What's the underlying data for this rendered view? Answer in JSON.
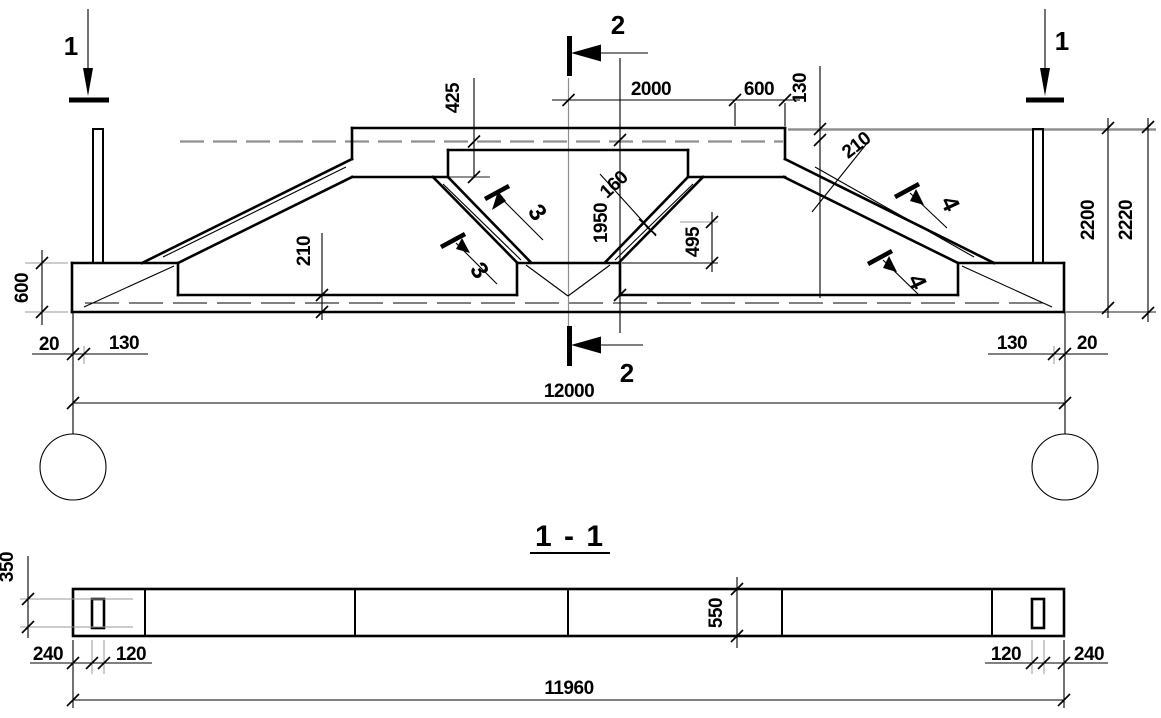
{
  "drawing": {
    "kind": "engineering-truss-drawing",
    "background": "#ffffff",
    "line_color": "#000000",
    "aux_line_color": "#8f8f8f"
  },
  "elevation": {
    "markers": {
      "cut1_left": "1",
      "cut1_right": "1",
      "cut2_top": "2",
      "cut2_bottom": "2",
      "cut3_upper": "3",
      "cut3_lower": "3",
      "cut4_upper": "4",
      "cut4_lower": "4"
    },
    "dims": {
      "top_center": "2000",
      "top_right": "600",
      "edge_130": "130",
      "depth_425": "425",
      "web_160": "160",
      "node_495": "495",
      "height_1950": "1950",
      "diag_210": "210",
      "chord_210": "210",
      "height_2200": "2200",
      "height_2220": "2220",
      "end_600": "600",
      "offset_left_20": "20",
      "inset_left_130": "130",
      "inset_right_130": "130",
      "offset_right_20": "20",
      "span_12000": "12000"
    }
  },
  "section": {
    "title": "1 - 1",
    "dims": {
      "post_350": "350",
      "end_left_240": "240",
      "post_left_120": "120",
      "height_550": "550",
      "post_right_120": "120",
      "end_right_240": "240",
      "length_11960": "11960"
    }
  }
}
